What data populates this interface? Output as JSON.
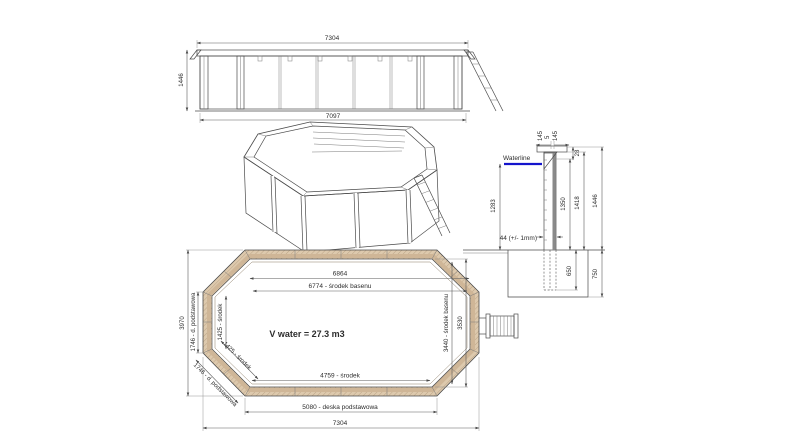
{
  "title": "Wooden octagonal pool technical drawing",
  "colors": {
    "line": "#4a4a4a",
    "dim_line": "#5a5a5a",
    "wood_fill": "#ddc9ad",
    "wood_band": "#cfb697",
    "wood_hatch": "#a98f6f",
    "section_wall_fill": "#efe6d4",
    "section_liner": "#8a8a8a",
    "waterline_blue": "#1414cc",
    "background": "#ffffff"
  },
  "side_view": {
    "dim_width_top": "7304",
    "dim_height_left": "1446",
    "dim_width_bottom": "7097"
  },
  "section_view": {
    "waterline_label": "Waterline",
    "cap_dim_left": "145",
    "cap_dim_mid": "5",
    "cap_dim_right": "145",
    "dim_cap_height": "28",
    "dim_water_depth": "1283",
    "dim_wall_1350": "1350",
    "dim_wall_1418": "1418",
    "dim_wall_1446": "1446",
    "wall_thickness_note": "44 (+/- 1mm)",
    "dim_below_650": "650",
    "dim_below_750": "750"
  },
  "plan_view": {
    "dim_inner_width": "6864",
    "dim_center_width": "6774 - środek basenu",
    "volume_label": "V water = 27.3 m3",
    "dim_bottom_center": "4759 - środek",
    "dim_base_plank": "5080 - deska podstawowa",
    "dim_overall_width": "7304",
    "dim_overall_height": "3970",
    "dim_left_base": "1746 - d. podstawowa",
    "dim_left_center": "1425 - środek",
    "dim_diag_center": "1425 - środek",
    "dim_diag_base": "1746 - d. podstawowa",
    "dim_center_height": "3440 - środek basenu",
    "dim_inner_height": "3530"
  }
}
